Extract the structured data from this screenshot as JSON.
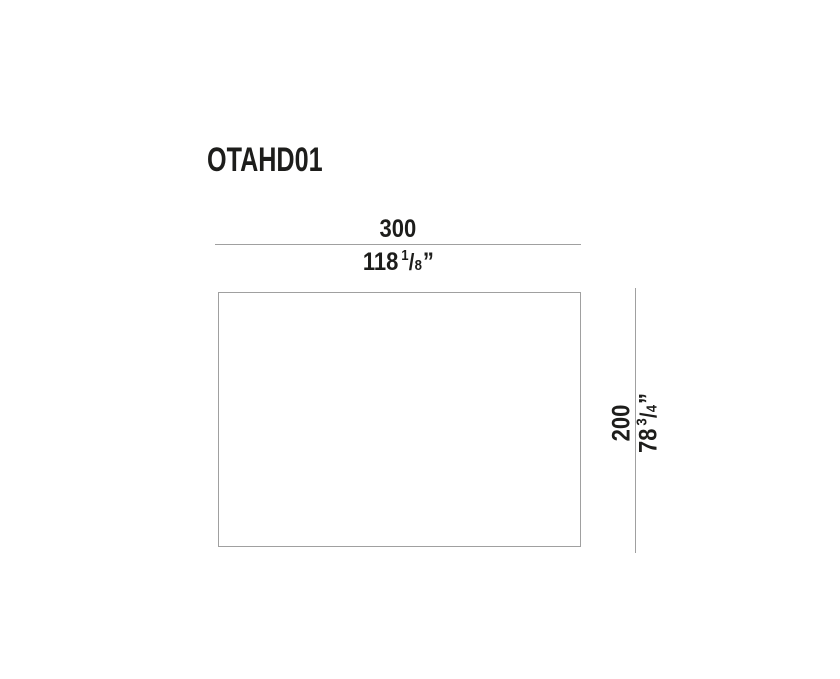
{
  "title": "OTAHD01",
  "colors": {
    "text": "#1d1d1b",
    "line": "#a0a0a0",
    "background": "#ffffff"
  },
  "width_dimension": {
    "cm": "300",
    "inches_whole": "118",
    "frac_numerator": "1",
    "frac_slash": "/",
    "frac_denominator": "8",
    "inch_mark": "”"
  },
  "height_dimension": {
    "cm": "200",
    "inches_whole": "78",
    "frac_numerator": "3",
    "frac_slash": "/",
    "frac_denominator": "4",
    "inch_mark": "”"
  }
}
